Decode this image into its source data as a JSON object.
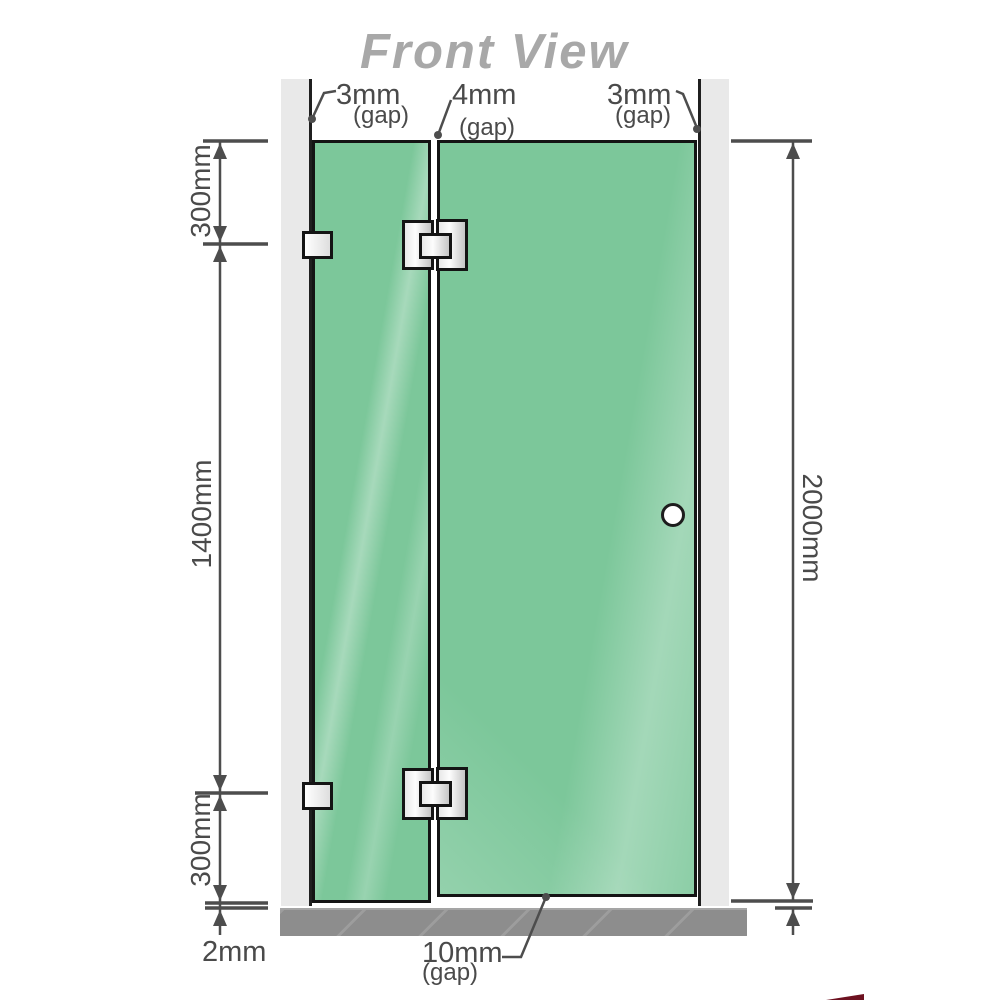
{
  "title": "Front View",
  "gaps": {
    "left": {
      "value": "3mm",
      "note": "(gap)"
    },
    "middle": {
      "value": "4mm",
      "note": "(gap)"
    },
    "right": {
      "value": "3mm",
      "note": "(gap)"
    },
    "bottom": {
      "value": "10mm",
      "note": "(gap)"
    }
  },
  "dims": {
    "left_top": "300mm",
    "left_middle": "1400mm",
    "left_bottom": "300mm",
    "floor_gap": "2mm",
    "total_height": "2000mm"
  },
  "colors": {
    "glass": "#7cc79a",
    "glass_border": "#141414",
    "wall_channel": "#e9e9e9",
    "floor": "#8d8d8d",
    "dimension": "#4d4d4d",
    "title": "#a8a8a8"
  }
}
